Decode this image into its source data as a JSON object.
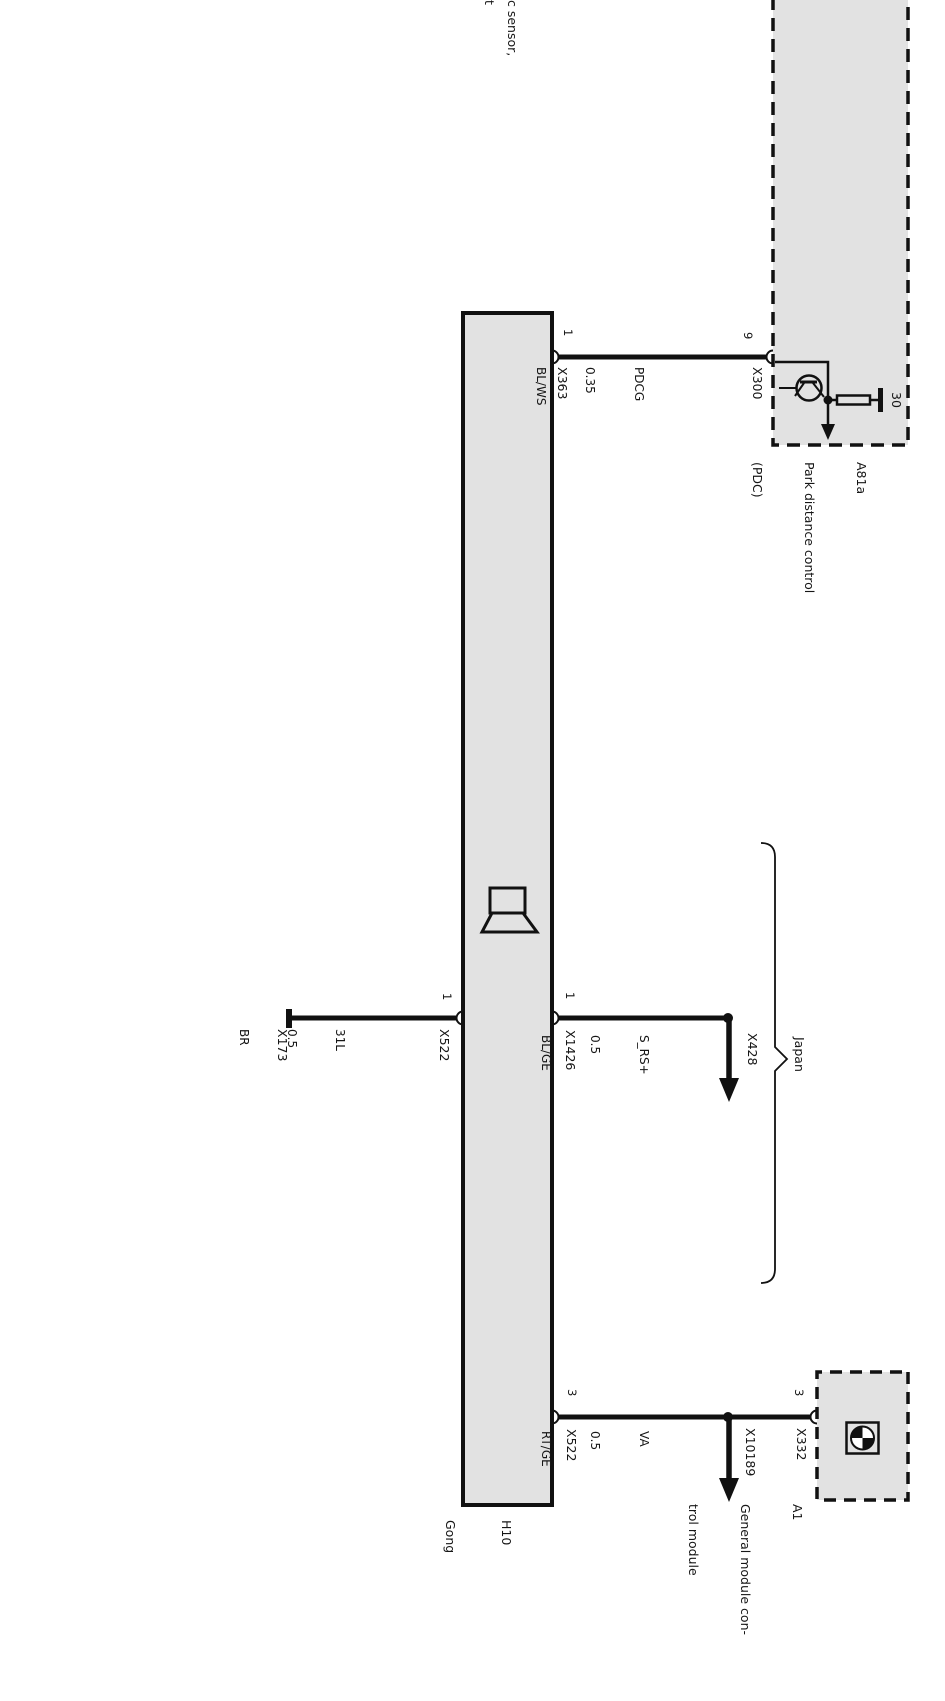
{
  "diagram": {
    "truncated_edge_label": {
      "line1": "c sensor,",
      "line2": "t"
    },
    "pdc_module": {
      "code": "A81a",
      "title_line1": "Park distance control",
      "title_line2": "(PDC)",
      "terminal_label": "30",
      "pin": "9",
      "connector": "X300"
    },
    "gong_module": {
      "code": "H10",
      "title": "Gong"
    },
    "gm_module": {
      "code": "A1",
      "title_line1": "General module con-",
      "title_line2": "trol module",
      "pin": "3",
      "connector": "X332"
    },
    "region_label": "Japan",
    "wires": {
      "pdcg": {
        "name": "PDCG",
        "gauge": "0.35",
        "color": "BL/WS",
        "gong_pin": "1",
        "gong_connector": "X363"
      },
      "ground": {
        "name": "31L",
        "gauge": "0.5",
        "color": "BR",
        "gong_pin": "1",
        "gong_connector": "X522",
        "terminal_connector": "X173"
      },
      "s_rs": {
        "name": "S_RS+",
        "gauge": "0.5",
        "color": "BL/GE",
        "gong_pin": "1",
        "gong_connector": "X1426",
        "branch_connector": "X428"
      },
      "va": {
        "name": "VA",
        "gauge": "0.5",
        "color": "RT/GE",
        "gong_pin": "3",
        "gong_connector": "X522",
        "branch_connector": "X10189"
      }
    },
    "colors": {
      "module_fill": "#e2e2e2",
      "line": "#111111",
      "background": "#ffffff"
    }
  }
}
